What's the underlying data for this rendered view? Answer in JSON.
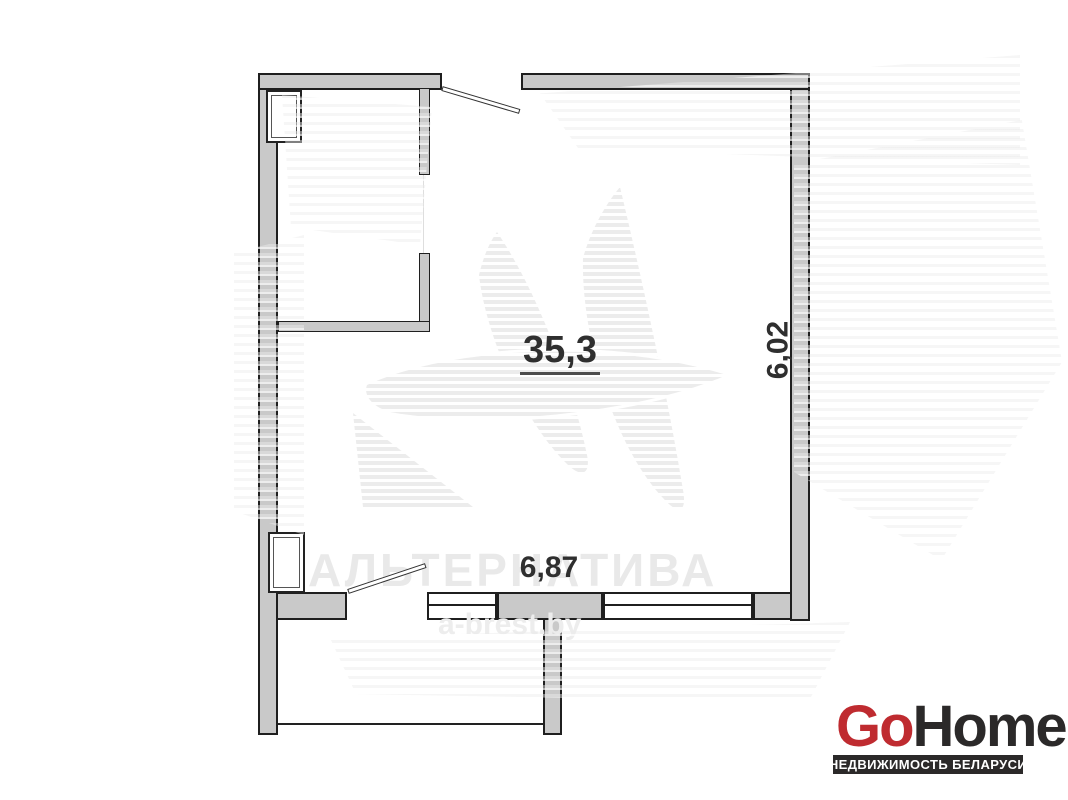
{
  "plan": {
    "area": "35,3",
    "dim_horizontal": "6,87",
    "dim_vertical": "6,02"
  },
  "watermark": {
    "brand": "АЛЬТЕРНАТИВА",
    "site": "a-brest.by"
  },
  "brand_logo": {
    "part1": "Go",
    "part2": "Home",
    "tagline": "НЕДВИЖИМОСТЬ БЕЛАРУСИ",
    "color_red": "#bf2b30",
    "color_dark": "#2b2929"
  },
  "colors": {
    "wall_fill": "#c9c9c9",
    "wall_outline": "#1f1f1f",
    "dimension_text": "#2f2f2f",
    "watermark_gray": "#ececec"
  }
}
